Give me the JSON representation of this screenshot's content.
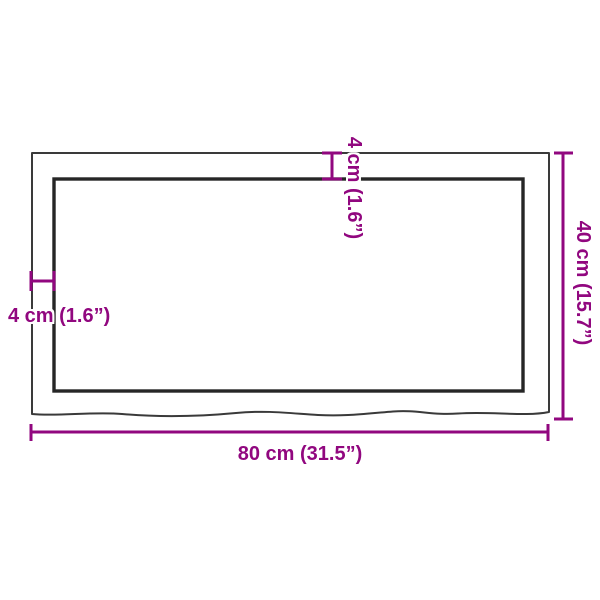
{
  "diagram": {
    "type": "product-dimension-diagram",
    "subject": "wooden table top (live edge), top view",
    "colors": {
      "dimension_accent": "#91077f",
      "outline_outer": "#3a3a3a",
      "outline_inner": "#262626",
      "background": "#ffffff"
    },
    "dimensions": {
      "width_bottom": {
        "label": "80 cm (31.5”)",
        "cm": "80",
        "inches": "31.5"
      },
      "height_right": {
        "label": "40 cm (15.7”)",
        "cm": "40",
        "inches": "15.7"
      },
      "thickness_top": {
        "label": "4 cm (1.6”)",
        "cm": "4",
        "inches": "1.6"
      },
      "thickness_left": {
        "label": "4 cm (1.6”)",
        "cm": "4",
        "inches": "1.6"
      }
    }
  }
}
